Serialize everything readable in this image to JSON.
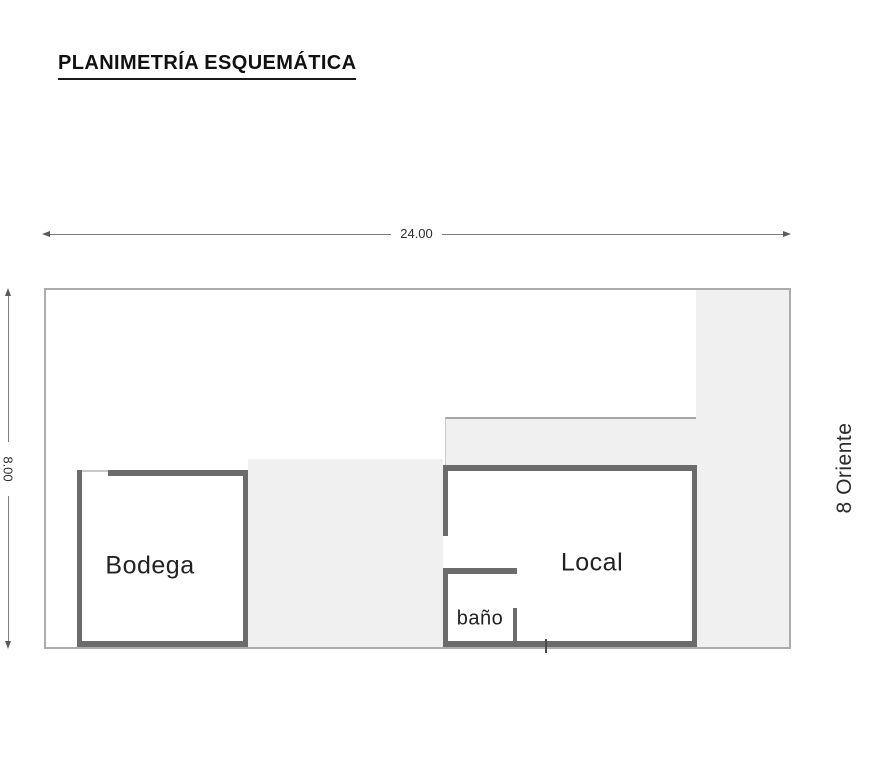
{
  "title": "PLANIMETRÍA ESQUEMÁTICA",
  "dims": {
    "horizontal": "24.00",
    "vertical": "8.00"
  },
  "street": "8 Oriente",
  "rooms": {
    "bodega": "Bodega",
    "local": "Local",
    "bano": "baño"
  },
  "colors": {
    "wall": "#6b6b6b",
    "parcel_border": "#acacac",
    "paved_area": "#f0f0f0",
    "dimension_line": "#7d7d7d",
    "text": "#1f1f1f"
  }
}
